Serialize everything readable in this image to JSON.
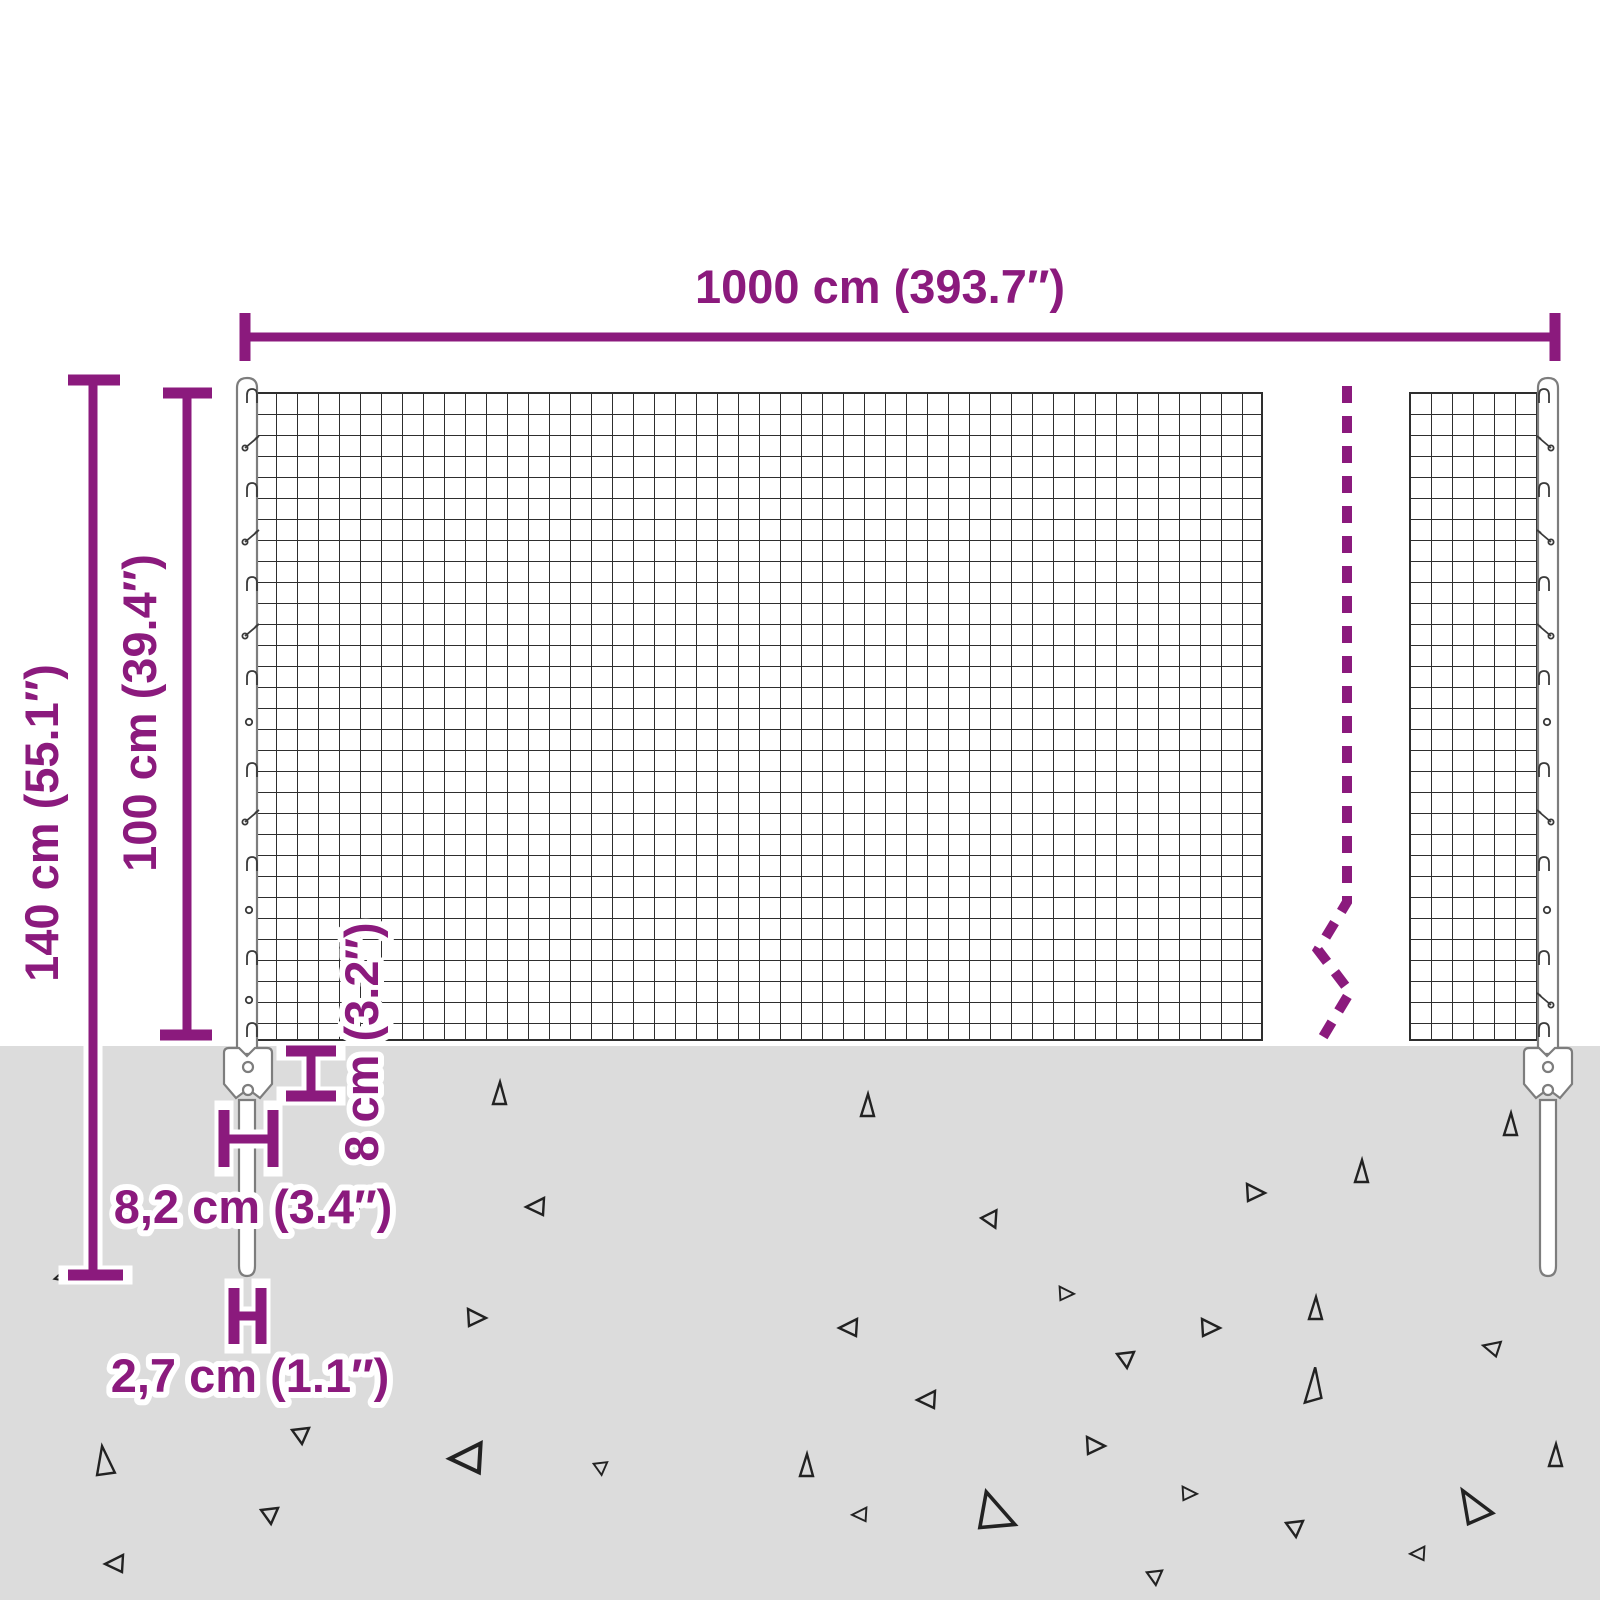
{
  "diagram": {
    "type": "product-dimension-diagram",
    "subject": "wire-mesh-fence-with-posts",
    "dimensions": {
      "total_width": "1000 cm (393.7″)",
      "total_height": "140 cm (55.1″)",
      "mesh_height": "100 cm (39.4″)",
      "anchor_plate_height": "8 cm (3.2″)",
      "anchor_plate_width": "8,2 cm (3.4″)",
      "post_width": "2,7 cm (1.1″)"
    },
    "colors": {
      "accent": "#8b1a7d",
      "ground": "#dcdcdc",
      "mesh_line": "#2e2e2e",
      "steel_outline": "#7d7d7d",
      "gravel": "#222222",
      "background": "#ffffff"
    }
  }
}
